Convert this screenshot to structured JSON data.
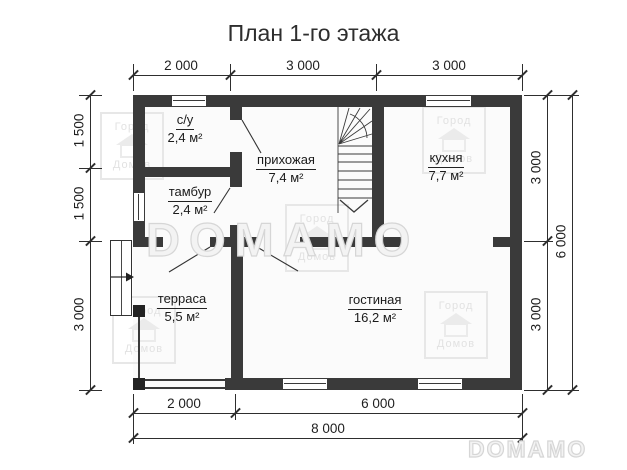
{
  "title": "План 1-го этажа",
  "rooms": {
    "su": {
      "name": "с/у",
      "area": "2,4 м²"
    },
    "tambur": {
      "name": "тамбур",
      "area": "2,4 м²"
    },
    "prihozhaya": {
      "name": "прихожая",
      "area": "7,4 м²"
    },
    "kuhnya": {
      "name": "кухня",
      "area": "7,7 м²"
    },
    "terrasa": {
      "name": "терраса",
      "area": "5,5 м²"
    },
    "gostinaya": {
      "name": "гостиная",
      "area": "16,2 м²"
    }
  },
  "dimensions": {
    "top": [
      "2 000",
      "3 000",
      "3 000"
    ],
    "left": [
      "1 500",
      "1 500",
      "3 000"
    ],
    "right_inner": [
      "3 000",
      "3 000"
    ],
    "right_total": "6 000",
    "bottom_inner": [
      "2 000",
      "6 000"
    ],
    "bottom_total": "8 000"
  },
  "watermark": {
    "brand": "DOMAMO",
    "logo_line1": "Город",
    "logo_line2": "Домов"
  },
  "colors": {
    "wall": "#3a3a3a",
    "line": "#2e2e2e",
    "watermark": "#d6d6d6",
    "background": "#ffffff"
  }
}
